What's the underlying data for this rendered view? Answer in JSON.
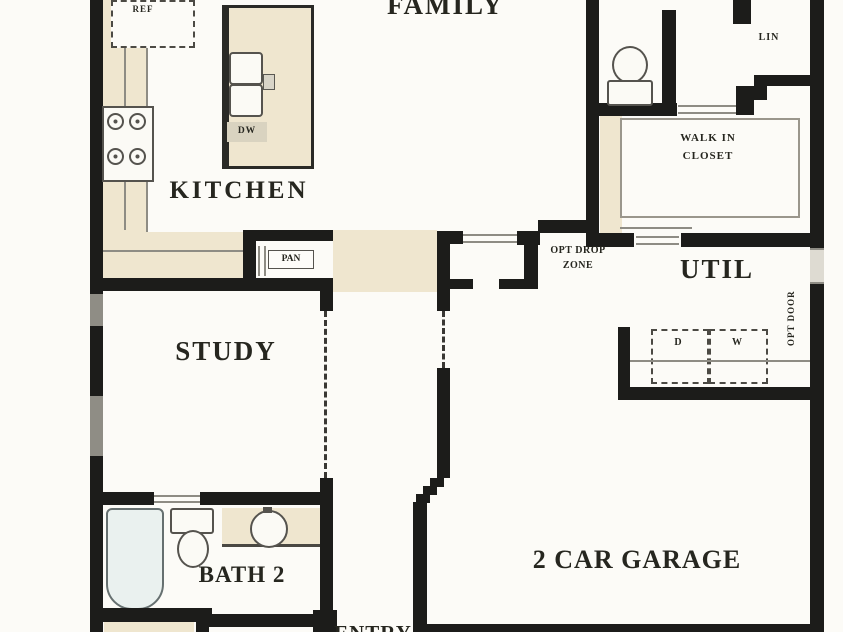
{
  "rooms": {
    "family": "FAMILY",
    "kitchen": "KITCHEN",
    "study": "STUDY",
    "bath2": "BATH 2",
    "util": "UTIL",
    "garage": "2 CAR GARAGE",
    "entry": "ENTRY",
    "walk_in_closet_line1": "WALK IN",
    "walk_in_closet_line2": "CLOSET",
    "pantry": "PAN",
    "linen": "LIN",
    "drop_zone_line1": "OPT DROP",
    "drop_zone_line2": "ZONE"
  },
  "fixtures": {
    "refrigerator": "REF",
    "dishwasher": "DW",
    "dryer": "D",
    "washer": "W",
    "opt_door": "OPT DOOR"
  },
  "colors": {
    "wall": "#1c1c1a",
    "counter": "#efe6cf",
    "line": "#8e8c84",
    "window": "#8f8d85",
    "text": "#26261f",
    "tub": "#eaf1ef",
    "background": "#fcfbf7"
  }
}
